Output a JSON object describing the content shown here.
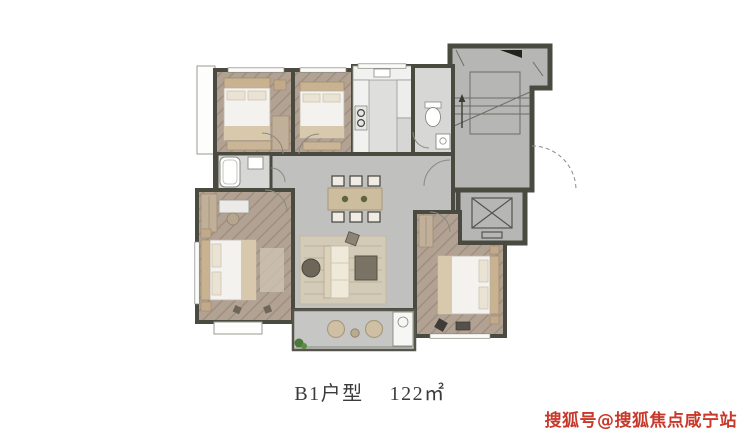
{
  "image": {
    "type": "floor-plan",
    "caption": {
      "unit_label": "B1户型",
      "area_label": "122㎡"
    },
    "watermark": {
      "text": "搜狐号@搜狐焦点咸宁站",
      "color": "#c8392b"
    },
    "colors": {
      "wall": "#4a4a40",
      "bedroom_floor": "#b2a294",
      "marble_floor": "#c0c0be",
      "common_floor": "#b6b6b4",
      "kitchen_floor": "#e9e9e7",
      "bath_floor": "#d7d7d5",
      "balcony_floor": "#c6c6c4",
      "wood_accent": "#c9b290",
      "bed_linen": "#f4f2ee",
      "plant_green": "#4a7a3a"
    },
    "icons": [
      "bed",
      "sofa",
      "dining-table",
      "bathtub",
      "toilet",
      "stairs",
      "elevator",
      "balcony-chair",
      "plant",
      "wardrobe",
      "desk"
    ]
  }
}
